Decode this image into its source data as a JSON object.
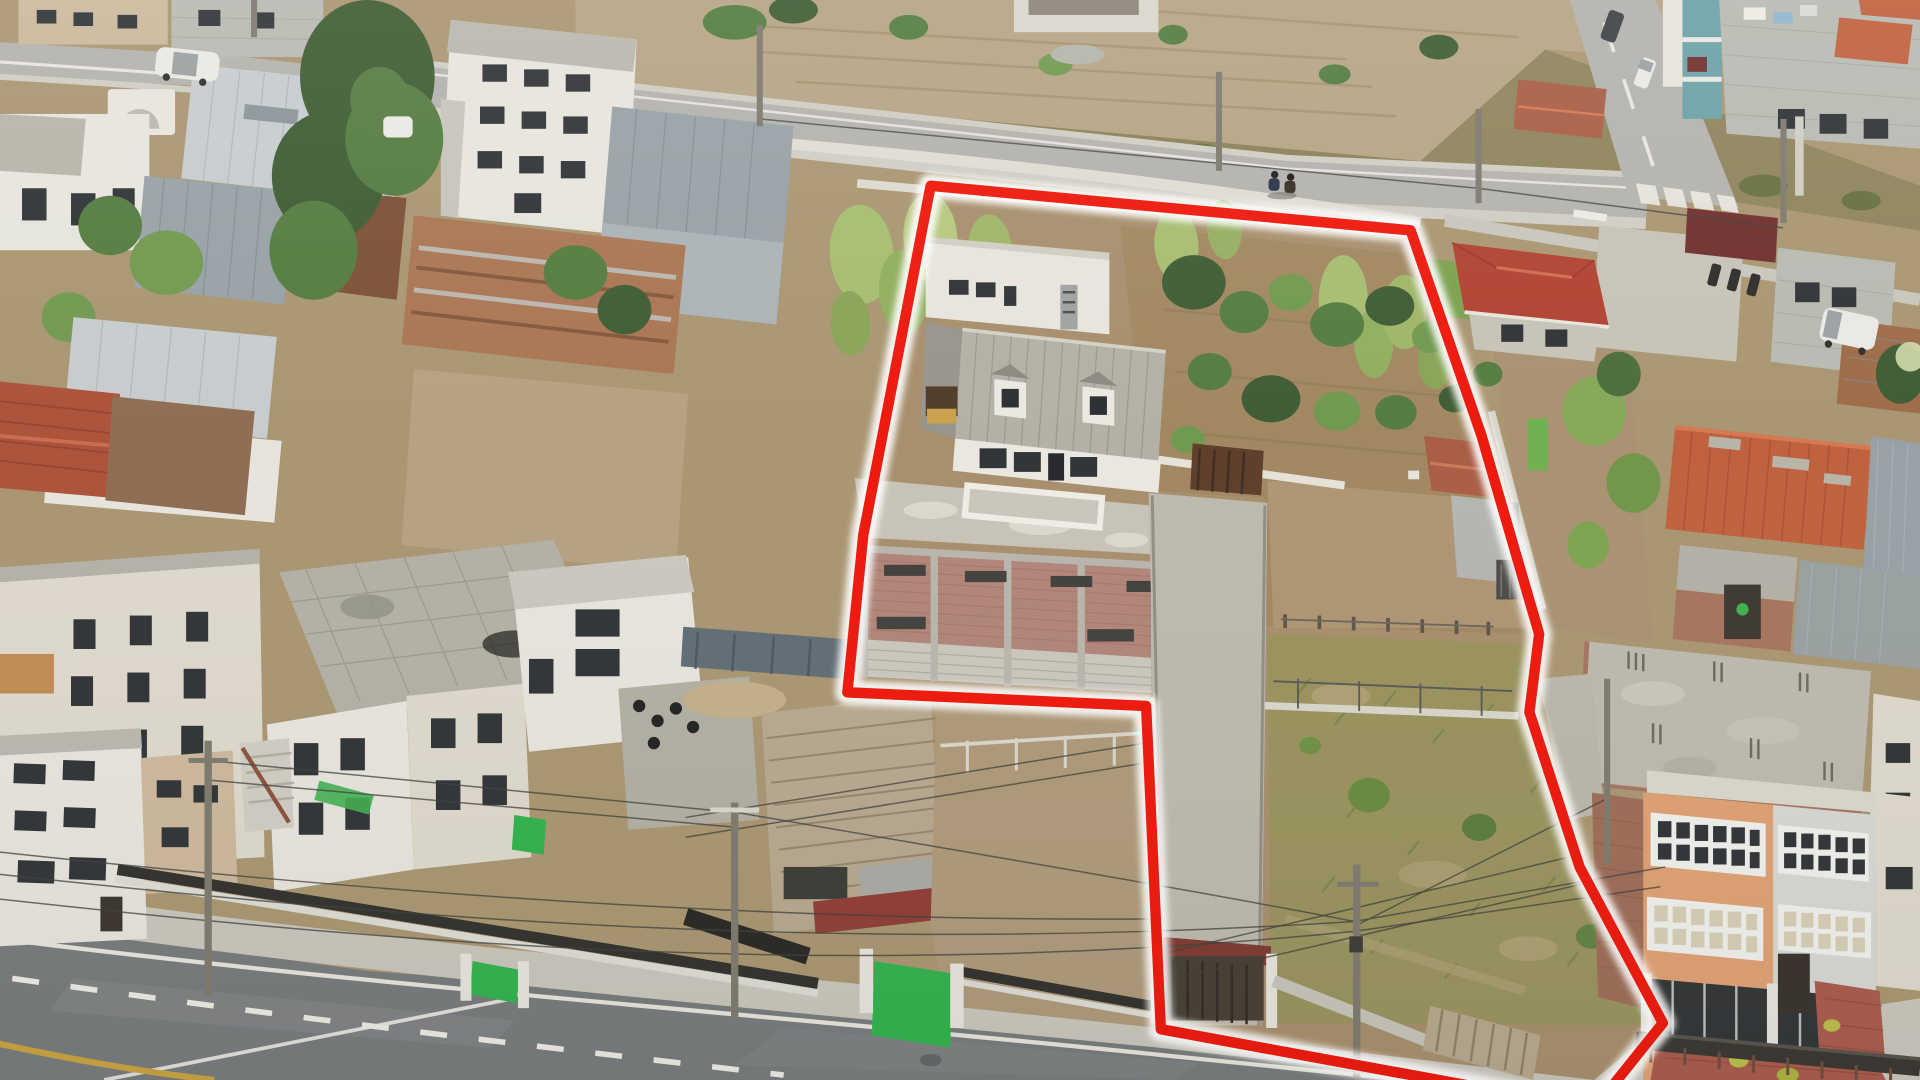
{
  "meta": {
    "type": "aerial-drone-photograph",
    "description": "Aerial drone view of an Andean town block; a large land plot with a dormered house, brick building, orchard trees and weedy field is outlined with a bright red boundary line; a wide asphalt road with white and yellow markings crosses the foreground and a second street with a crosswalk runs at the top right.",
    "width_px": 1920,
    "height_px": 1080
  },
  "boundary": {
    "points": "760,150 1152,186 1210,352 1257,512 1249,575 1290,700 1358,826 1302,895 948,831 936,570 692,559 705,432",
    "color": "#ee1509",
    "glow_color": "#ffffff",
    "stroke_width": 8.5
  },
  "palette": {
    "base": "#a8946f",
    "field": "#b5a383",
    "scrub": "#8a7f58",
    "asphaltLight": "#b2b1ac",
    "asphaltDark": "#75797a",
    "sidewalk": "#c8c5bb",
    "lineWhite": "#eceae3",
    "lineYellow": "#c9a23f",
    "lotDirt": "#a68d6b",
    "orchardDirt": "#a0865f",
    "weeds": "#98915c",
    "treeDark": "#3c5a31",
    "treeMid": "#527a3d",
    "treeLight": "#6f974d",
    "cane": "#a4bc6e",
    "roofGray": "#b2afa4",
    "roofSilver": "#c6cbcd",
    "roofSteel": "#96a0a4",
    "roofRust": "#9c6a46",
    "roofRustDark": "#7a4e33",
    "tileRed": "#bf5f3c",
    "tileDeep": "#a85b42",
    "hipRed": "#b0402f",
    "wallWhite": "#e6e4dc",
    "wallCream": "#ddd8cb",
    "wallTan": "#cbb79b",
    "stone": "#b7b9b1",
    "concrete": "#c6c2b6",
    "concreteDark": "#b1ada1",
    "brick": "#b08377",
    "orange": "#df9f72",
    "teal": "#69a0a5",
    "maroon": "#6d2d2c",
    "glassDark": "#2e3134",
    "paneCream": "#d6cdb5",
    "greenGate": "#2eb14b",
    "woodFence": "#b5a78c",
    "brickYard": "#a8584a",
    "wire": "#3e3e3a",
    "pole": "#7d786c",
    "carWhite": "#e9e8e3",
    "carDark": "#3b3f42",
    "motoGreen": "#3fae4e",
    "boundary": "#ee1509",
    "boundaryGlow": "#ffffff"
  },
  "scene": {
    "objects": [
      {
        "name": "property-boundary",
        "note": "bright red outlined plot, glowing white halo"
      },
      {
        "name": "main-house",
        "note": "gray gabled corrugated roof with two white dormer windows"
      },
      {
        "name": "house-rear-wing",
        "note": "white two story section with chimney"
      },
      {
        "name": "brick-building",
        "note": "unplastered brick facade with concrete frame and dark window slits"
      },
      {
        "name": "terrace",
        "note": "white balustraded terrace in front of house"
      },
      {
        "name": "orchard",
        "note": "dirt orchard with many green fruit trees inside plot"
      },
      {
        "name": "weedy-field",
        "note": "dry weedy lot in south part of plot"
      },
      {
        "name": "driveway",
        "note": "long walled driveway with brown gate and small red roofed street gate"
      },
      {
        "name": "tile-casita",
        "note": "small terracotta roofed outbuilding inside plot"
      },
      {
        "name": "main-road",
        "note": "wide diagonal asphalt road, white lane lines, dashed center line, yellow edge line"
      },
      {
        "name": "upper-road",
        "note": "back street with white wall, two pedestrians sitting on curb"
      },
      {
        "name": "cross-road",
        "note": "street at top right with zebra crosswalk, dark car and white car"
      },
      {
        "name": "orange-building",
        "note": "three story peach building with white framed window bands"
      },
      {
        "name": "red-hip-roof-house",
        "note": "small house with red hip roof right of plot"
      },
      {
        "name": "terracotta-roof-building",
        "note": "large orange tile roof midway on right side"
      },
      {
        "name": "construction-slab",
        "note": "unfinished concrete slab with rebar bottom right"
      },
      {
        "name": "left-buildings",
        "note": "white, silver and rust roofed houses on left block"
      },
      {
        "name": "carport",
        "note": "wood plank carport roof near bottom center"
      },
      {
        "name": "green-gates",
        "note": "two bright green street gates in white wall"
      },
      {
        "name": "street-fence",
        "note": "black iron fence over white base wall along sidewalk"
      },
      {
        "name": "utility-poles",
        "note": "concrete poles with many crossing wires"
      },
      {
        "name": "white-car",
        "note": "white sedan on top left road"
      },
      {
        "name": "white-van",
        "note": "white van parked at right edge"
      },
      {
        "name": "pedestrians",
        "note": "two people sitting on the upper road curb"
      }
    ]
  }
}
